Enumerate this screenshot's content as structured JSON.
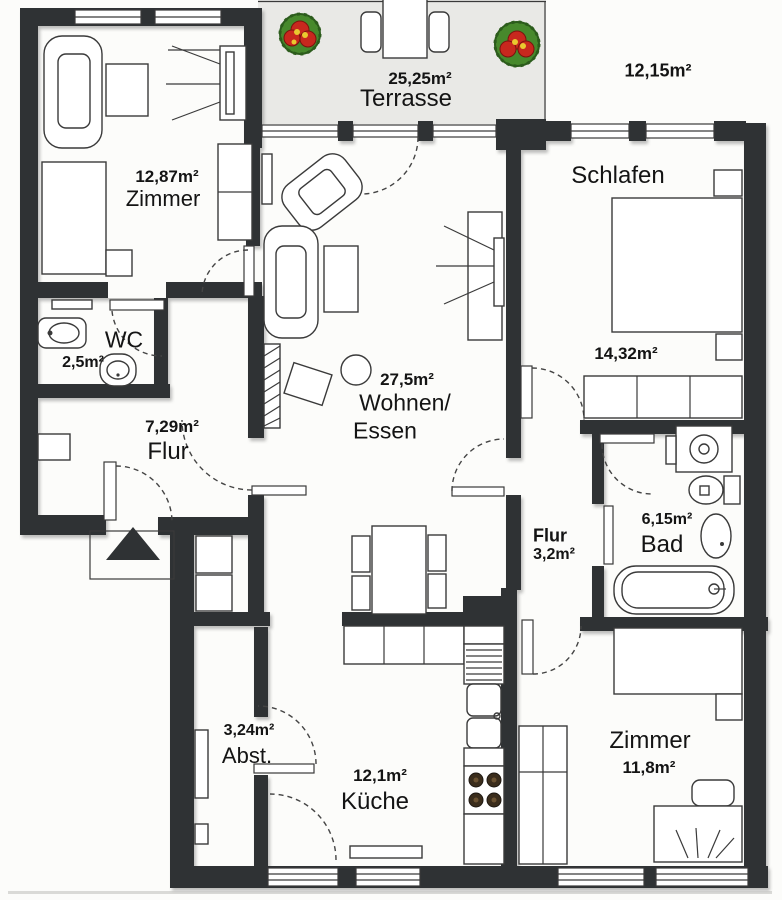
{
  "title": "Apartment floor plan",
  "rooms": {
    "zimmer1": {
      "area": "12,87m²",
      "name": "Zimmer"
    },
    "terrasse": {
      "area": "25,25m²",
      "name": "Terrasse"
    },
    "garden": {
      "area": "12,15m²"
    },
    "schlafen": {
      "name": "Schlafen",
      "area": "14,32m²"
    },
    "wc": {
      "name": "WC",
      "area": "2,5m²"
    },
    "flur": {
      "area": "7,29m²",
      "name": "Flur"
    },
    "wohnen": {
      "area": "27,5m²",
      "name_line1": "Wohnen/",
      "name_line2": "Essen"
    },
    "flur2": {
      "name": "Flur",
      "area": "3,2m²"
    },
    "bad": {
      "area": "6,15m²",
      "name": "Bad"
    },
    "abst": {
      "area": "3,24m²",
      "name": "Abst."
    },
    "kueche": {
      "area": "12,1m²",
      "name": "Küche"
    },
    "zimmer2": {
      "name": "Zimmer",
      "area": "11,8m²"
    }
  },
  "colors": {
    "wall": "#2f3234",
    "terrace_fill": "#e9e9e6",
    "paper": "#fcfcfa",
    "line": "#3a3a3a",
    "flower_red": "#c8281e",
    "flower_green": "#47892c",
    "flower_yellow": "#e9c92f"
  }
}
